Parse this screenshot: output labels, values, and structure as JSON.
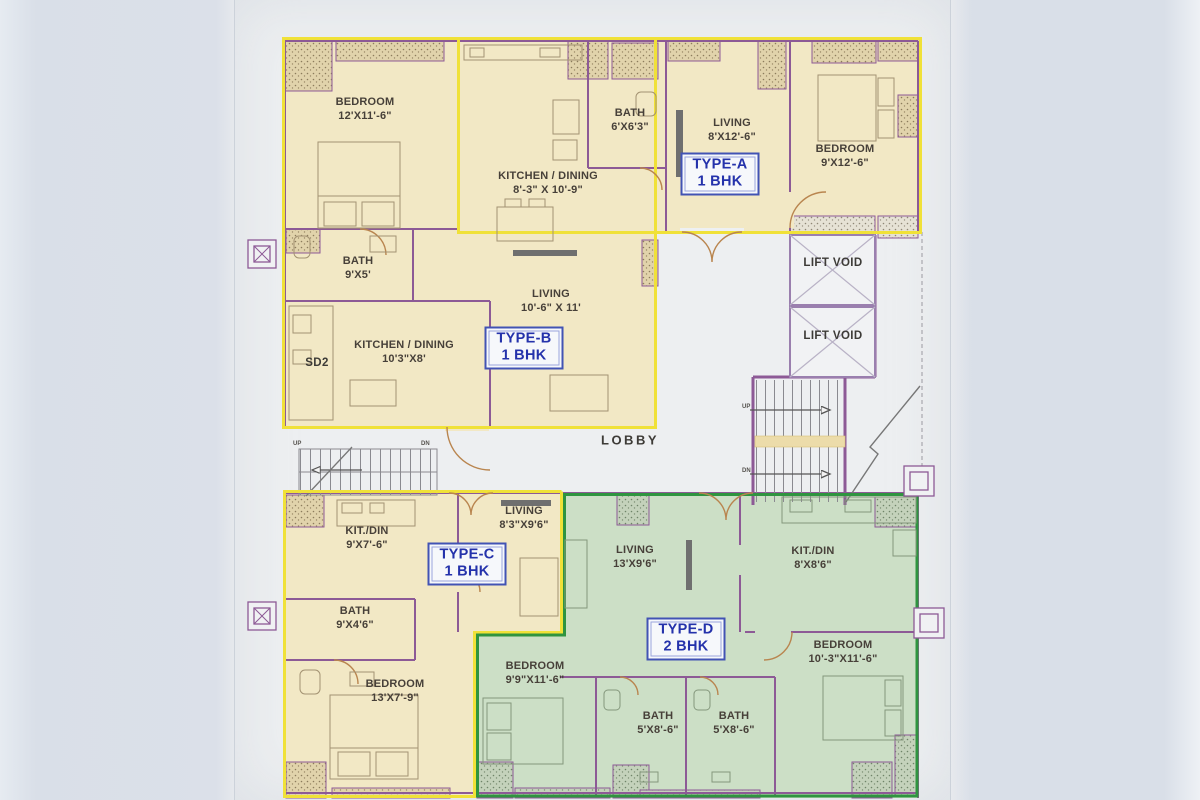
{
  "plan": {
    "units": [
      {
        "code": "TYPE-A",
        "size": "1 BHK"
      },
      {
        "code": "TYPE-B",
        "size": "1 BHK"
      },
      {
        "code": "TYPE-C",
        "size": "1 BHK"
      },
      {
        "code": "TYPE-D",
        "size": "2 BHK"
      }
    ],
    "rooms": [
      {
        "name": "BEDROOM",
        "dims": "12'X11'-6\""
      },
      {
        "name": "BATH",
        "dims": "9'X5'"
      },
      {
        "name": "KITCHEN / DINING",
        "dims": "10'3\"X8'"
      },
      {
        "name": "LIVING",
        "dims": "10'-6\" X 11'"
      },
      {
        "name": "KITCHEN / DINING",
        "dims": "8'-3\" X 10'-9\""
      },
      {
        "name": "BATH",
        "dims": "6'X6'3\""
      },
      {
        "name": "LIVING",
        "dims": "8'X12'-6\""
      },
      {
        "name": "BEDROOM",
        "dims": "9'X12'-6\""
      },
      {
        "name": "LIVING",
        "dims": "8'3\"X9'6\""
      },
      {
        "name": "KIT./DIN",
        "dims": "9'X7'-6\""
      },
      {
        "name": "BATH",
        "dims": "9'X4'6\""
      },
      {
        "name": "BEDROOM",
        "dims": "13'X7'-9\""
      },
      {
        "name": "LIVING",
        "dims": "13'X9'6\""
      },
      {
        "name": "KIT./DIN",
        "dims": "8'X8'6\""
      },
      {
        "name": "BEDROOM",
        "dims": "9'9\"X11'-6\""
      },
      {
        "name": "BEDROOM",
        "dims": "10'-3\"X11'-6\""
      },
      {
        "name": "BATH",
        "dims": "5'X8'-6\""
      },
      {
        "name": "BATH",
        "dims": "5'X8'-6\""
      }
    ],
    "areas": {
      "lobby": "LOBBY",
      "lift_void_upper": "LIFT VOID",
      "lift_void_lower": "LIFT VOID",
      "sd2": "SD2"
    },
    "stairs": {
      "up": "UP",
      "dn": "DN"
    },
    "colors": {
      "unit_yellow_fill": "#f2e8c5",
      "unit_green_fill": "#ccdfc6",
      "boundary_yellow": "#f0e138",
      "boundary_green": "#2f9440",
      "wall_purple": "#8d5a96",
      "label_blue": "#2432ab",
      "text_dark": "#474039"
    }
  }
}
